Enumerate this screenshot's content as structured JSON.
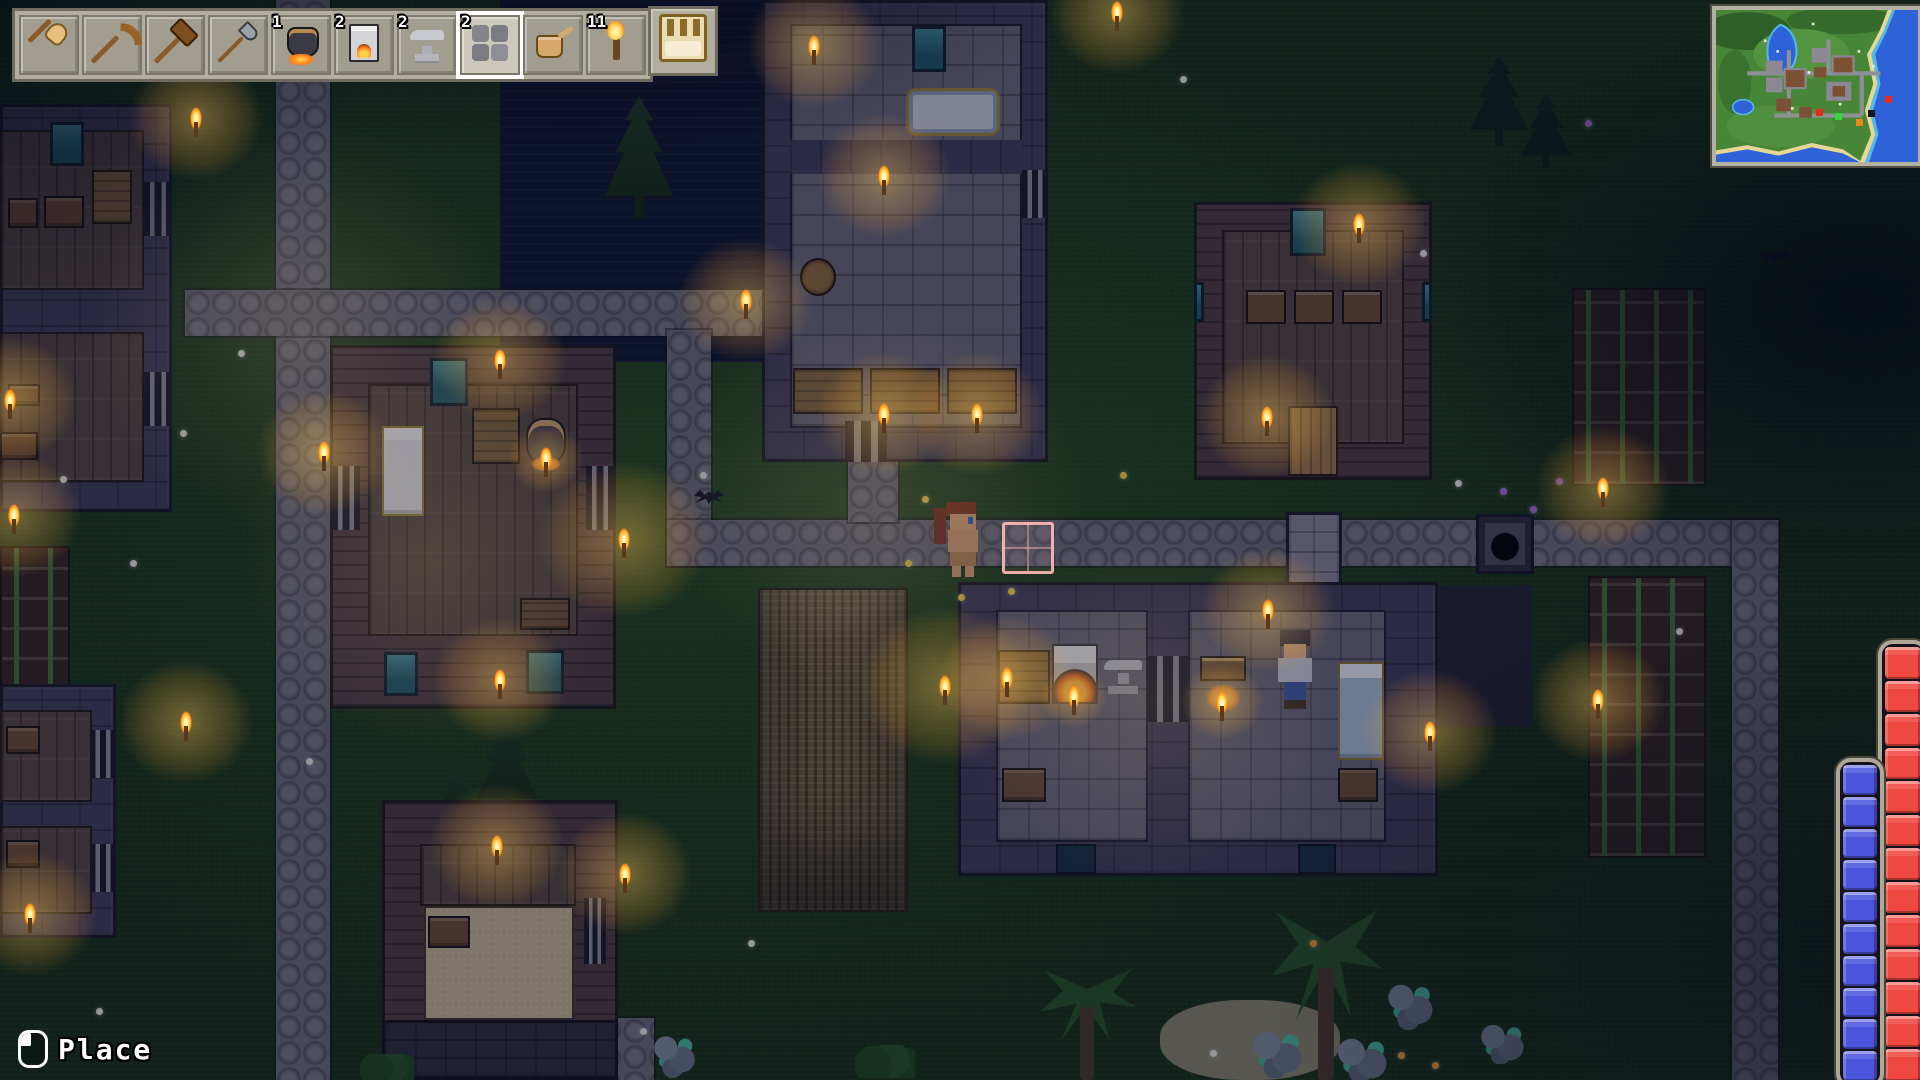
{
  "ui": {
    "hotbar": {
      "slots": [
        {
          "name": "shovel",
          "icon": "i-shovel",
          "count": ""
        },
        {
          "name": "pickaxe",
          "icon": "i-pickaxe",
          "count": ""
        },
        {
          "name": "hammer",
          "icon": "i-hammer",
          "count": ""
        },
        {
          "name": "axe",
          "icon": "i-axe",
          "count": ""
        },
        {
          "name": "cauldron",
          "icon": "i-cauldron",
          "count": "1"
        },
        {
          "name": "furnace",
          "icon": "i-furnace",
          "count": "2"
        },
        {
          "name": "anvil",
          "icon": "i-anvil",
          "count": "2"
        },
        {
          "name": "stone",
          "icon": "i-stone",
          "count": "2",
          "selected": true
        },
        {
          "name": "watering-can",
          "icon": "i-watering-can",
          "count": ""
        },
        {
          "name": "torch",
          "icon": "i-torch",
          "count": "11"
        }
      ],
      "bag": {
        "name": "bag",
        "icon": "i-bag"
      }
    },
    "minimap": {
      "markers": [
        {
          "color": "#e82c20",
          "x": 100,
          "y": 99
        },
        {
          "color": "#30d838",
          "x": 119,
          "y": 103
        },
        {
          "color": "#f08818",
          "x": 140,
          "y": 109
        },
        {
          "color": "#15151a",
          "x": 152,
          "y": 100
        },
        {
          "color": "#e82c20",
          "x": 169,
          "y": 86
        }
      ]
    },
    "bars": {
      "health": {
        "color": "#ef4840",
        "segments": 13
      },
      "mana": {
        "color": "#4d55de",
        "segments": 10
      }
    },
    "action_hint": {
      "button": "left-mouse-button",
      "label": "Place"
    }
  },
  "world": {
    "entities": [
      {
        "t": "water",
        "x": 500,
        "y": 0,
        "w": 278,
        "h": 362,
        "n": "pond-water"
      },
      {
        "t": "path",
        "x": 276,
        "y": 0,
        "w": 54,
        "h": 1080,
        "n": "stone-path-west"
      },
      {
        "t": "path",
        "x": 185,
        "y": 290,
        "w": 577,
        "h": 46,
        "n": "stone-path-upper"
      },
      {
        "t": "path",
        "x": 667,
        "y": 330,
        "w": 44,
        "h": 236,
        "n": "stone-path-mid-vertical"
      },
      {
        "t": "path",
        "x": 667,
        "y": 520,
        "w": 1112,
        "h": 46,
        "n": "stone-path-main"
      },
      {
        "t": "path",
        "x": 1732,
        "y": 520,
        "w": 46,
        "h": 560,
        "n": "stone-path-east"
      },
      {
        "t": "path",
        "x": 848,
        "y": 458,
        "w": 50,
        "h": 64,
        "n": "stone-path-door-stub"
      },
      {
        "t": "path",
        "x": 596,
        "y": 1018,
        "w": 58,
        "h": 62,
        "n": "stone-path-south"
      },
      {
        "t": "crops",
        "x": 0,
        "y": 546,
        "w": 70,
        "h": 146,
        "n": "corn-field-west"
      },
      {
        "t": "crops",
        "x": 1572,
        "y": 288,
        "w": 134,
        "h": 198,
        "n": "corn-field-east-upper"
      },
      {
        "t": "crops",
        "x": 1588,
        "y": 576,
        "w": 118,
        "h": 282,
        "n": "corn-field-east-lower"
      },
      {
        "t": "wheat",
        "x": 758,
        "y": 588,
        "w": 150,
        "h": 324,
        "n": "wheat-field"
      },
      {
        "t": "sand",
        "x": 1160,
        "y": 1000,
        "w": 180,
        "h": 80,
        "n": "sand-patch"
      },
      {
        "t": "wall-stone",
        "x": 762,
        "y": 0,
        "w": 286,
        "h": 462,
        "n": "stone-house-north"
      },
      {
        "t": "floor-stone",
        "x": 790,
        "y": 24,
        "w": 232,
        "h": 404
      },
      {
        "t": "inner-wall",
        "x": 790,
        "y": 140,
        "w": 232,
        "h": 34
      },
      {
        "t": "window",
        "x": 912,
        "y": 26,
        "w": 34,
        "h": 46
      },
      {
        "t": "tub",
        "x": 906,
        "y": 88,
        "w": 94,
        "h": 48
      },
      {
        "t": "barrel",
        "x": 800,
        "y": 258,
        "w": 36,
        "h": 38
      },
      {
        "t": "table",
        "x": 793,
        "y": 368,
        "w": 70,
        "h": 46
      },
      {
        "t": "table",
        "x": 870,
        "y": 368,
        "w": 70,
        "h": 46
      },
      {
        "t": "table",
        "x": 947,
        "y": 368,
        "w": 70,
        "h": 46
      },
      {
        "t": "door",
        "x": 1022,
        "y": 170,
        "w": 26,
        "h": 48
      },
      {
        "t": "door",
        "x": 845,
        "y": 421,
        "w": 42,
        "h": 41
      },
      {
        "t": "wall-wood",
        "x": 1194,
        "y": 202,
        "w": 238,
        "h": 278,
        "n": "wood-house-northeast"
      },
      {
        "t": "floor-wood",
        "x": 1222,
        "y": 230,
        "w": 182,
        "h": 214
      },
      {
        "t": "window",
        "x": 1290,
        "y": 208,
        "w": 36,
        "h": 48
      },
      {
        "t": "dresser",
        "x": 1246,
        "y": 290,
        "w": 40,
        "h": 34
      },
      {
        "t": "dresser",
        "x": 1294,
        "y": 290,
        "w": 40,
        "h": 34
      },
      {
        "t": "dresser",
        "x": 1342,
        "y": 290,
        "w": 40,
        "h": 34
      },
      {
        "t": "door-wood",
        "x": 1288,
        "y": 406,
        "w": 50,
        "h": 70
      },
      {
        "t": "window",
        "x": 1194,
        "y": 282,
        "w": 10,
        "h": 40
      },
      {
        "t": "window",
        "x": 1422,
        "y": 282,
        "w": 10,
        "h": 40
      },
      {
        "t": "wall-stone",
        "x": 0,
        "y": 104,
        "w": 172,
        "h": 408,
        "n": "stone-house-west"
      },
      {
        "t": "floor-wood",
        "x": 0,
        "y": 130,
        "w": 144,
        "h": 160
      },
      {
        "t": "floor-wood",
        "x": 0,
        "y": 332,
        "w": 144,
        "h": 150
      },
      {
        "t": "window",
        "x": 50,
        "y": 122,
        "w": 34,
        "h": 44
      },
      {
        "t": "chest",
        "x": 8,
        "y": 198,
        "w": 30,
        "h": 30
      },
      {
        "t": "chest",
        "x": 44,
        "y": 196,
        "w": 40,
        "h": 32
      },
      {
        "t": "table",
        "x": 92,
        "y": 170,
        "w": 40,
        "h": 54
      },
      {
        "t": "chest",
        "x": 8,
        "y": 384,
        "w": 32,
        "h": 22
      },
      {
        "t": "chest",
        "x": 0,
        "y": 432,
        "w": 38,
        "h": 28
      },
      {
        "t": "door",
        "x": 144,
        "y": 182,
        "w": 28,
        "h": 54
      },
      {
        "t": "door",
        "x": 144,
        "y": 372,
        "w": 28,
        "h": 54
      },
      {
        "t": "wall-stone",
        "x": 0,
        "y": 684,
        "w": 116,
        "h": 254,
        "n": "stone-house-southwest"
      },
      {
        "t": "floor-wood",
        "x": 0,
        "y": 710,
        "w": 92,
        "h": 92
      },
      {
        "t": "floor-wood",
        "x": 0,
        "y": 826,
        "w": 92,
        "h": 88
      },
      {
        "t": "chest",
        "x": 6,
        "y": 726,
        "w": 34,
        "h": 28
      },
      {
        "t": "chest",
        "x": 6,
        "y": 840,
        "w": 34,
        "h": 28
      },
      {
        "t": "door",
        "x": 90,
        "y": 730,
        "w": 26,
        "h": 48
      },
      {
        "t": "door",
        "x": 90,
        "y": 844,
        "w": 26,
        "h": 48
      },
      {
        "t": "pine",
        "x": 600,
        "y": 96,
        "w": 78,
        "h": 122,
        "n": "pine-tree"
      },
      {
        "t": "pine",
        "x": 472,
        "y": 712,
        "w": 70,
        "h": 106,
        "n": "pine-tree"
      },
      {
        "t": "pine",
        "x": 428,
        "y": 768,
        "w": 54,
        "h": 60,
        "n": "pine-tree"
      },
      {
        "t": "wall-wood",
        "x": 330,
        "y": 345,
        "w": 286,
        "h": 364,
        "n": "wood-house-center"
      },
      {
        "t": "floor-wood",
        "x": 368,
        "y": 384,
        "w": 210,
        "h": 252
      },
      {
        "t": "bed",
        "x": 382,
        "y": 426,
        "w": 42,
        "h": 90
      },
      {
        "t": "table",
        "x": 472,
        "y": 408,
        "w": 48,
        "h": 56
      },
      {
        "t": "cauldron",
        "x": 526,
        "y": 418,
        "w": 40,
        "h": 46
      },
      {
        "t": "crate",
        "x": 520,
        "y": 598,
        "w": 50,
        "h": 32
      },
      {
        "t": "window",
        "x": 430,
        "y": 358,
        "w": 38,
        "h": 48
      },
      {
        "t": "window",
        "x": 384,
        "y": 652,
        "w": 34,
        "h": 44
      },
      {
        "t": "window",
        "x": 526,
        "y": 650,
        "w": 38,
        "h": 44
      },
      {
        "t": "door",
        "x": 332,
        "y": 466,
        "w": 28,
        "h": 64
      },
      {
        "t": "door",
        "x": 586,
        "y": 466,
        "w": 28,
        "h": 64
      },
      {
        "t": "wall-wood",
        "x": 382,
        "y": 800,
        "w": 236,
        "h": 246,
        "n": "wood-house-south"
      },
      {
        "t": "floor-wood",
        "x": 420,
        "y": 844,
        "w": 156,
        "h": 62
      },
      {
        "t": "floor-sand",
        "x": 424,
        "y": 906,
        "w": 150,
        "h": 114
      },
      {
        "t": "chest",
        "x": 428,
        "y": 916,
        "w": 42,
        "h": 32
      },
      {
        "t": "door",
        "x": 584,
        "y": 898,
        "w": 22,
        "h": 66
      },
      {
        "t": "wall-dark",
        "x": 382,
        "y": 1020,
        "w": 236,
        "h": 60
      },
      {
        "t": "stone-annex",
        "x": 1286,
        "y": 512,
        "w": 56,
        "h": 104,
        "n": "smithy-chimney"
      },
      {
        "t": "px",
        "x": 1436,
        "y": 585,
        "w": 96,
        "h": 142,
        "c": "#221f2c",
        "n": "dark-annex"
      },
      {
        "t": "wall-stone",
        "x": 958,
        "y": 582,
        "w": 480,
        "h": 294,
        "n": "smithy"
      },
      {
        "t": "floor-stone",
        "x": 996,
        "y": 610,
        "w": 152,
        "h": 232
      },
      {
        "t": "floor-stone",
        "x": 1188,
        "y": 610,
        "w": 198,
        "h": 232
      },
      {
        "t": "door",
        "x": 1148,
        "y": 656,
        "w": 40,
        "h": 66
      },
      {
        "t": "table",
        "x": 998,
        "y": 650,
        "w": 52,
        "h": 54
      },
      {
        "t": "furnace",
        "x": 1052,
        "y": 644,
        "w": 46,
        "h": 60
      },
      {
        "t": "anvil",
        "x": 1102,
        "y": 656,
        "w": 42,
        "h": 40
      },
      {
        "t": "chest",
        "x": 1002,
        "y": 768,
        "w": 44,
        "h": 34
      },
      {
        "t": "campfire",
        "x": 1200,
        "y": 656,
        "w": 46,
        "h": 54
      },
      {
        "t": "bed-blue",
        "x": 1338,
        "y": 662,
        "w": 46,
        "h": 98
      },
      {
        "t": "chest",
        "x": 1338,
        "y": 768,
        "w": 40,
        "h": 34
      },
      {
        "t": "window-dark",
        "x": 1056,
        "y": 844,
        "w": 40,
        "h": 30
      },
      {
        "t": "window-dark",
        "x": 1298,
        "y": 844,
        "w": 38,
        "h": 30
      },
      {
        "t": "cellar",
        "x": 1476,
        "y": 514,
        "w": 58,
        "h": 60,
        "n": "cellar-entrance"
      },
      {
        "t": "px",
        "x": 934,
        "y": 508,
        "w": 12,
        "h": 36,
        "c": "#7a2c16",
        "n": "player-ponytail"
      },
      {
        "t": "px",
        "x": 946,
        "y": 502,
        "w": 30,
        "h": 14,
        "c": "#8a3318",
        "n": "player-hair"
      },
      {
        "t": "px",
        "x": 950,
        "y": 514,
        "w": 26,
        "h": 16,
        "c": "#e8a873",
        "n": "player-face"
      },
      {
        "t": "px",
        "x": 968,
        "y": 517,
        "w": 5,
        "h": 7,
        "c": "#2a62c8",
        "n": "player-eye"
      },
      {
        "t": "px",
        "x": 948,
        "y": 530,
        "w": 30,
        "h": 22,
        "c": "#dca06e",
        "n": "player-body"
      },
      {
        "t": "px",
        "x": 950,
        "y": 552,
        "w": 26,
        "h": 14,
        "c": "#b9854c",
        "n": "player-shorts"
      },
      {
        "t": "px",
        "x": 952,
        "y": 566,
        "w": 9,
        "h": 11,
        "c": "#dca06e",
        "n": "player-leg"
      },
      {
        "t": "px",
        "x": 965,
        "y": 566,
        "w": 9,
        "h": 11,
        "c": "#dca06e",
        "n": "player-leg"
      },
      {
        "t": "px",
        "x": 1280,
        "y": 630,
        "w": 30,
        "h": 16,
        "c": "#1c2240",
        "n": "npc-hair"
      },
      {
        "t": "px",
        "x": 1284,
        "y": 644,
        "w": 22,
        "h": 14,
        "c": "#e8b48a",
        "n": "npc-face"
      },
      {
        "t": "px",
        "x": 1278,
        "y": 658,
        "w": 34,
        "h": 24,
        "c": "#c8ccd4",
        "n": "npc-shirt"
      },
      {
        "t": "px",
        "x": 1284,
        "y": 682,
        "w": 22,
        "h": 20,
        "c": "#3a55a0",
        "n": "npc-pants"
      },
      {
        "t": "px",
        "x": 1284,
        "y": 700,
        "w": 22,
        "h": 9,
        "c": "#40301e",
        "n": "npc-boots"
      },
      {
        "t": "cursor",
        "x": 1002,
        "y": 522,
        "w": 52,
        "h": 52,
        "n": "placement-cursor"
      },
      {
        "t": "pine-dark",
        "x": 1466,
        "y": 56,
        "w": 66,
        "h": 90
      },
      {
        "t": "pine-dark",
        "x": 1518,
        "y": 94,
        "w": 56,
        "h": 74
      },
      {
        "t": "palm",
        "x": 1272,
        "y": 900,
        "w": 110,
        "h": 180,
        "n": "palm-tree"
      },
      {
        "t": "palm",
        "x": 1040,
        "y": 962,
        "w": 96,
        "h": 118,
        "n": "palm-tree"
      },
      {
        "t": "tealrock",
        "x": 1250,
        "y": 1028,
        "w": 56,
        "h": 50
      },
      {
        "t": "tealrock",
        "x": 1334,
        "y": 1036,
        "w": 58,
        "h": 46
      },
      {
        "t": "tealrock",
        "x": 1386,
        "y": 980,
        "w": 50,
        "h": 50
      },
      {
        "t": "tealrock",
        "x": 1478,
        "y": 1022,
        "w": 50,
        "h": 42
      },
      {
        "t": "tealrock",
        "x": 652,
        "y": 1032,
        "w": 46,
        "h": 46
      },
      {
        "t": "bush",
        "x": 360,
        "y": 1054,
        "w": 54,
        "h": 26
      },
      {
        "t": "bush",
        "x": 855,
        "y": 1045,
        "w": 60,
        "h": 33
      },
      {
        "t": "rock",
        "x": 688,
        "y": 38,
        "w": 30,
        "h": 24
      },
      {
        "t": "bat",
        "x": 694,
        "y": 490,
        "w": 30,
        "h": 16,
        "n": "bat"
      },
      {
        "t": "bat",
        "x": 1758,
        "y": 248,
        "w": 34,
        "h": 18,
        "n": "bat"
      },
      {
        "t": "glow2",
        "x": 20,
        "y": 50,
        "w": 560,
        "h": 560
      },
      {
        "t": "glow2",
        "x": 600,
        "y": 240,
        "w": 560,
        "h": 520
      },
      {
        "t": "glow2",
        "x": 170,
        "y": 300,
        "w": 520,
        "h": 520
      },
      {
        "t": "glow2",
        "x": 890,
        "y": 460,
        "w": 520,
        "h": 480
      }
    ],
    "torches": [
      [
        196,
        118
      ],
      [
        10,
        400
      ],
      [
        14,
        515
      ],
      [
        186,
        722
      ],
      [
        30,
        914
      ],
      [
        814,
        46
      ],
      [
        884,
        176
      ],
      [
        746,
        300
      ],
      [
        884,
        414
      ],
      [
        977,
        414
      ],
      [
        1117,
        12
      ],
      [
        1359,
        224
      ],
      [
        1267,
        417
      ],
      [
        500,
        360
      ],
      [
        324,
        452
      ],
      [
        624,
        539,
        230
      ],
      [
        500,
        680
      ],
      [
        945,
        686,
        230
      ],
      [
        1007,
        678
      ],
      [
        1268,
        610
      ],
      [
        1430,
        732
      ],
      [
        497,
        846
      ],
      [
        625,
        874
      ],
      [
        1603,
        488
      ],
      [
        1598,
        700
      ],
      [
        1074,
        696,
        90
      ],
      [
        1222,
        702,
        110
      ],
      [
        546,
        458,
        100
      ]
    ],
    "flowers": [
      {
        "c": "#e8e8dc",
        "pts": [
          [
            238,
            350
          ],
          [
            180,
            430
          ],
          [
            60,
            476
          ],
          [
            700,
            472
          ],
          [
            748,
            940
          ],
          [
            640,
            1028
          ],
          [
            1180,
            76
          ],
          [
            1210,
            1050
          ],
          [
            1676,
            628
          ],
          [
            1420,
            250
          ],
          [
            96,
            1008
          ],
          [
            306,
            758
          ],
          [
            130,
            560
          ],
          [
            1455,
            480
          ]
        ]
      },
      {
        "c": "#ffd83a",
        "pts": [
          [
            922,
            496
          ],
          [
            1008,
            588
          ],
          [
            1120,
            472
          ],
          [
            958,
            594
          ],
          [
            905,
            560
          ]
        ]
      },
      {
        "c": "#ff9a20",
        "pts": [
          [
            1398,
            1052
          ],
          [
            1432,
            1062
          ],
          [
            1310,
            940
          ]
        ]
      },
      {
        "c": "#b06ae0",
        "pts": [
          [
            1500,
            488
          ],
          [
            1530,
            506
          ],
          [
            1556,
            478
          ],
          [
            1585,
            120
          ]
        ]
      }
    ]
  }
}
